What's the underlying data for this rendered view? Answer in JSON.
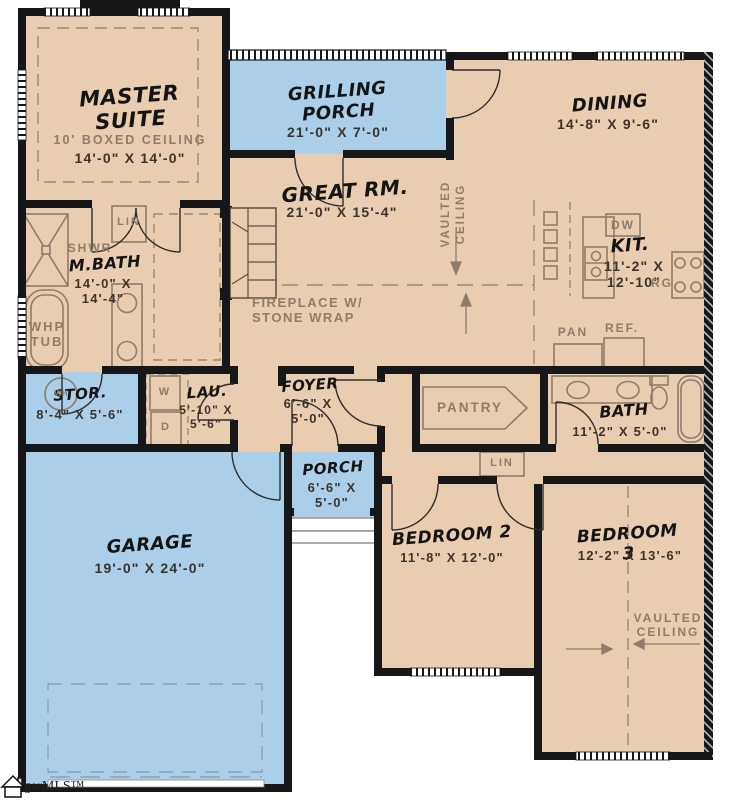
{
  "meta": {
    "logo": "garMLS™"
  },
  "colors": {
    "interior": "#e9cdb1",
    "outdoor": "#abcfe9",
    "wall": "#17171a",
    "fixture_line": "#8d7d6a",
    "dims_text": "#3c342c"
  },
  "rooms": {
    "master": {
      "name": "MASTER\nSUITE",
      "ceiling": "10' BOXED CEILING",
      "dims": "14'-0\" X 14'-0\""
    },
    "grilling_porch": {
      "name": "GRILLING\nPORCH",
      "dims": "21'-0\" X 7'-0\""
    },
    "dining": {
      "name": "DINING",
      "dims": "14'-8\" X 9'-6\""
    },
    "great_room": {
      "name": "GREAT RM.",
      "dims": "21'-0\" X 15'-4\"",
      "ceiling": "VAULTED\nCEILING",
      "fireplace": "FIREPLACE W/\nSTONE WRAP"
    },
    "kitchen": {
      "name": "KIT.",
      "dims": "11'-2\" X\n12'-10\"",
      "dishwasher": "DW",
      "range": "RG",
      "pantry_cabinet": "PAN",
      "refrigerator": "REF."
    },
    "master_bath": {
      "name": "M.BATH",
      "dims": "14'-0\" X\n14'-4\"",
      "shower": "SHWR",
      "tub": "WHP\nTUB",
      "linen": "LIN"
    },
    "storage": {
      "name": "STOR.",
      "dims": "8'-4\" X 5'-6\"",
      "water_heater": "WH"
    },
    "laundry": {
      "name": "LAU.",
      "dims": "5'-10\" X\n5'-6\"",
      "washer": "W",
      "dryer": "D"
    },
    "foyer": {
      "name": "FOYER",
      "dims": "6'-6\" X\n5'-0\""
    },
    "pantry": {
      "name": "PANTRY"
    },
    "bath": {
      "name": "BATH",
      "dims": "11'-2\" X 5'-0\"",
      "linen": "LIN"
    },
    "porch": {
      "name": "PORCH",
      "dims": "6'-6\" X\n5'-0\""
    },
    "garage": {
      "name": "GARAGE",
      "dims": "19'-0\" X 24'-0\""
    },
    "bedroom2": {
      "name": "BEDROOM 2",
      "dims": "11'-8\" X 12'-0\""
    },
    "bedroom3": {
      "name": "BEDROOM 3",
      "dims": "12'-2\" X 13'-6\"",
      "ceiling": "VAULTED\nCEILING"
    }
  }
}
